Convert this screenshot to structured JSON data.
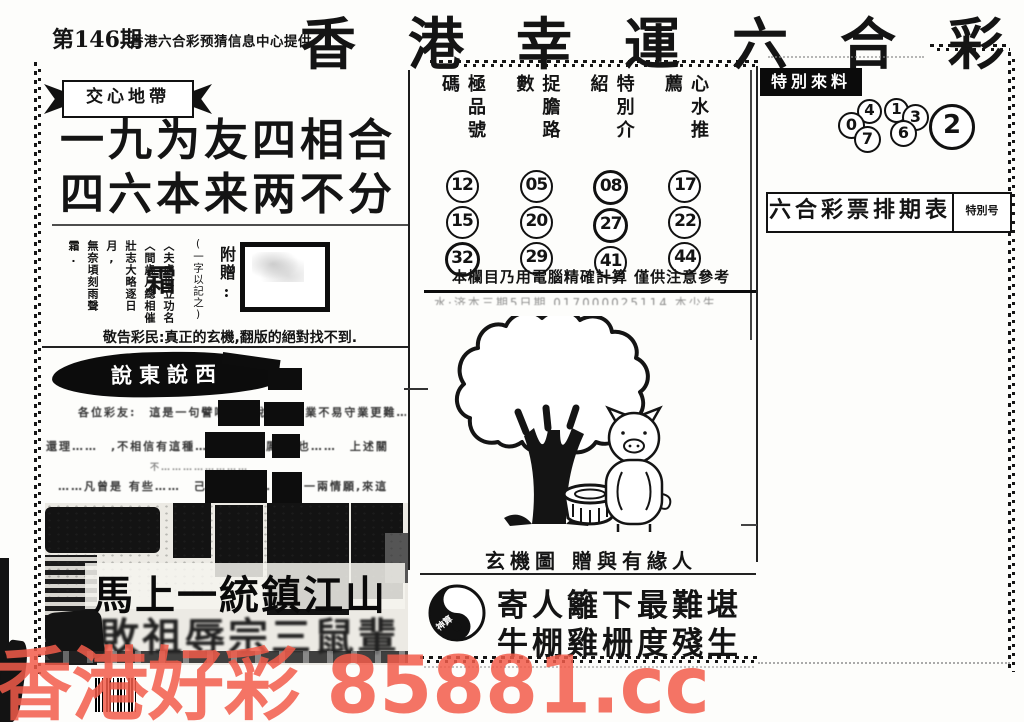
{
  "header": {
    "issue": "第146期",
    "provider": "香港六合彩预猜信息中心提供",
    "title": "香港幸運六合彩"
  },
  "left": {
    "ribbon": "交心地帶",
    "slogan1": "一九为友四相合",
    "slogan2": "四六本来两不分",
    "gift": {
      "label": "附贈:",
      "note": "(一字以記之)",
      "word": "霜",
      "poem": [
        "〈夫處世立功名",
        "〈間歲月總相催",
        "壯志大略逐日月,",
        "無奈頃刻雨聲霜."
      ]
    },
    "notice": "敬告彩民:真正的玄機,翻版的絕對找不到.",
    "gossip": {
      "title": "說東說西",
      "line1": "各位彩友:　這是一句譬喻……說明了創業不易守業更難……",
      "line2": "還理……　,不相信有這種……門 那麼厲害 也……　上述關",
      "line3": "不……………………",
      "line4": "……凡曾是 有些……　己……這麼……　,一兩情願,來這"
    },
    "photo": {
      "caption1": "馬上一統鎮江山",
      "caption2": "敗祖辱宗三鼠輩"
    }
  },
  "picks": {
    "columns": [
      {
        "header": "極品號碼",
        "numbers": [
          "12",
          "15",
          "32"
        ]
      },
      {
        "header": "捉膽路數",
        "numbers": [
          "05",
          "20",
          "29"
        ]
      },
      {
        "header": "特別介紹",
        "numbers": [
          "08",
          "27",
          "41"
        ]
      },
      {
        "header": "心水推薦",
        "numbers": [
          "17",
          "22",
          "44"
        ]
      }
    ],
    "disclaimer": "本欄目乃用電腦精確計算 僅供注意參考",
    "faded_line": "水·济本三期5日期 017000025114 本少生"
  },
  "mystery": {
    "caption": "玄機圖 贈與有緣人"
  },
  "verse": {
    "seal": "神算",
    "line1": "寄人籬下最難堪",
    "line2": "牛棚雞栅度殘生"
  },
  "right": {
    "special_label": "特別來料",
    "group1": [
      "0",
      "4",
      "7"
    ],
    "group2": [
      "1",
      "3",
      "6"
    ],
    "final": "2",
    "schedule_title": "六合彩票排期表",
    "schedule_tag": "特別号"
  },
  "watermark": "香港好彩 85881.cc",
  "colors": {
    "ink": "#141414",
    "watermark": "#f25c4a"
  }
}
